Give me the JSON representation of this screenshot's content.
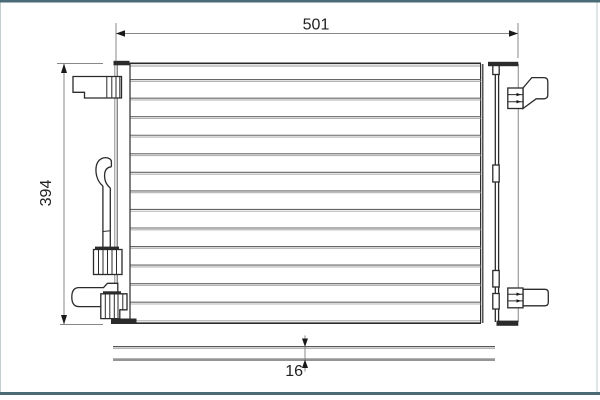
{
  "drawing": {
    "kind": "condenser technical drawing",
    "dimensions": {
      "width": {
        "label": "501"
      },
      "height": {
        "label": "394"
      },
      "depth": {
        "label": "16"
      }
    },
    "core": {
      "tube_count": 13
    }
  },
  "colors": {
    "frame_teal": "#4a6a75",
    "edge_light": "#c2cdd0",
    "line_dark": "#2b2b2b",
    "line_mid": "#555555",
    "tube_dark": "#666666",
    "tube_light": "#b3b3b3",
    "dim_line": "#888888",
    "text": "#222222"
  }
}
